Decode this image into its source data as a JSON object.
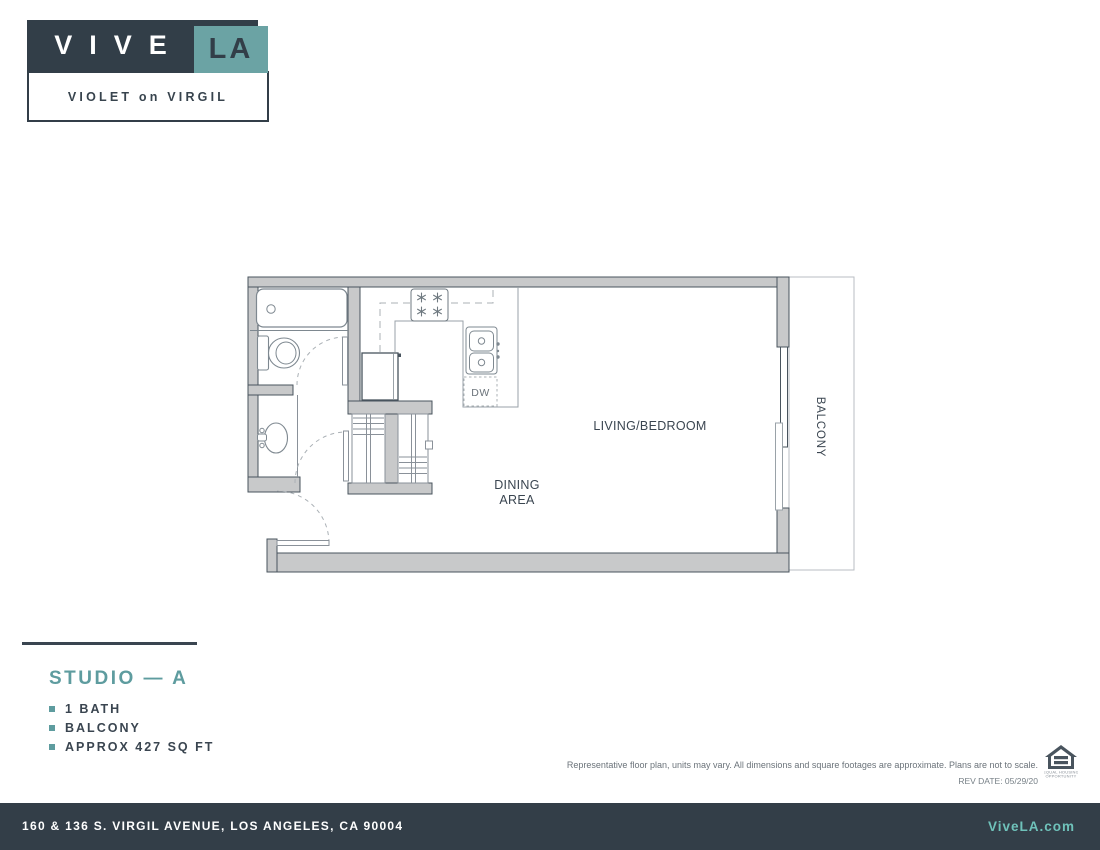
{
  "logo": {
    "brand_main": "VIVE",
    "brand_accent": "LA",
    "property": "VIOLET on VIRGIL"
  },
  "plan_labels": {
    "living": "LIVING/BEDROOM",
    "dining_line1": "DINING",
    "dining_line2": "AREA",
    "balcony": "BALCONY",
    "dishwasher": "DW"
  },
  "unit": {
    "title": "STUDIO — A",
    "features": [
      "1 BATH",
      "BALCONY",
      "APPROX 427 SQ FT"
    ]
  },
  "legal": {
    "disclaimer": "Representative floor plan, units may vary. All dimensions and square footages are approximate. Plans are not to scale.",
    "rev_date": "REV DATE: 05/29/20",
    "equal_housing_line1": "EQUAL HOUSING",
    "equal_housing_line2": "OPPORTUNITY"
  },
  "footer": {
    "address": "160 & 136 S. VIRGIL AVENUE, LOS ANGELES, CA 90004",
    "website": "ViveLA.com"
  },
  "colors": {
    "navy": "#323E48",
    "logo_teal": "#6BA3A4",
    "heading_teal": "#5E9C9F",
    "link_teal": "#6FC2BA",
    "wall_fill": "#C8C9CA",
    "wall_outline": "#49545E",
    "fixture_line": "#7E8890",
    "light_line": "#ABB1B6",
    "label_text": "#3A4550"
  }
}
